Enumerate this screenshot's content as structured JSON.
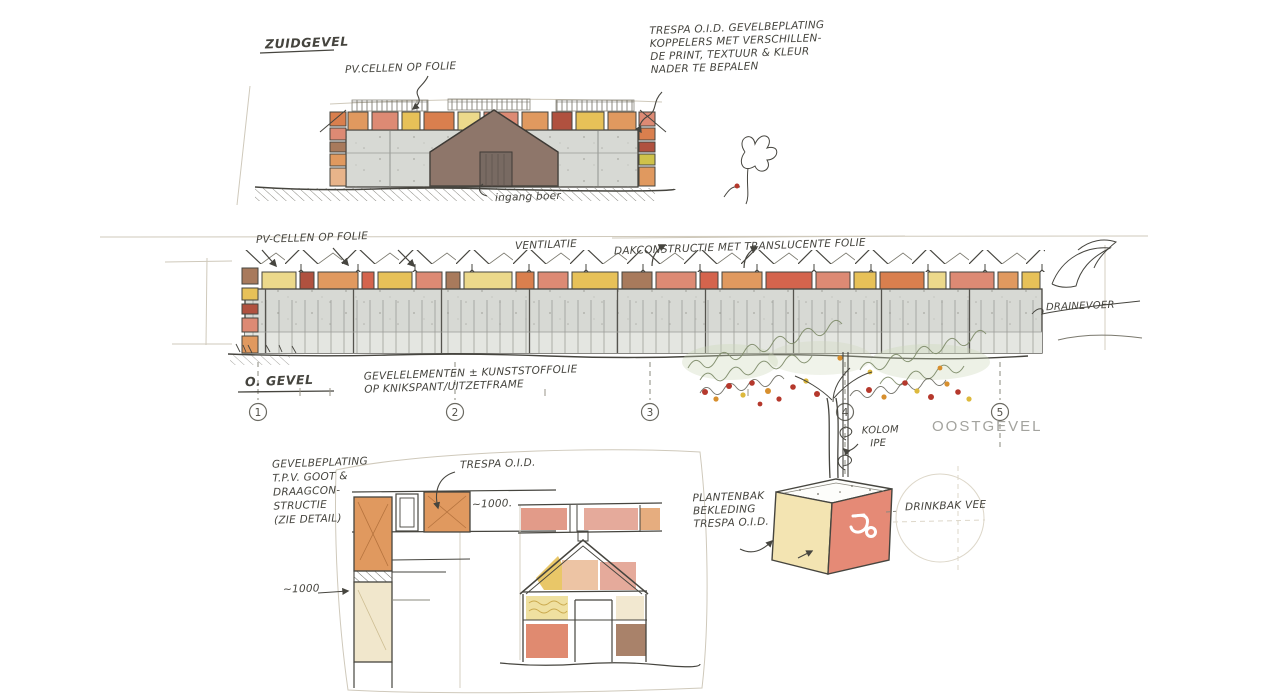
{
  "colors": {
    "ink": "#46453f",
    "paper": "#ffffff",
    "wall_gray": "#d7d9d4",
    "wall_gray_light": "#e4e6e1",
    "accent_orange": "#e0995f",
    "accent_deep_orange": "#d97f4e",
    "accent_yellow_pale": "#ecd98b",
    "accent_yellow_gold": "#e7c158",
    "accent_salmon": "#dd8a74",
    "accent_red": "#d4644d",
    "accent_dark_red": "#b0513f",
    "accent_brown": "#a87a5c",
    "accent_pink": "#e5aa9b",
    "gable_brown": "#8e766a",
    "planter_salmon": "#e58a76",
    "planter_yellow": "#f3e4b2",
    "foliage_green": "#ccd6b8",
    "fruit_red": "#b5382c",
    "fruit_orange": "#d78f2e",
    "fruit_yellow": "#ddb93c",
    "caption_gray": "#a3a39e"
  },
  "south": {
    "title": "ZUIDGEVEL",
    "pv_label": "PV.CELLEN OP FOLIE",
    "entrance_label": "ingang boer",
    "note": [
      "TRESPA O.I.D. GEVELBEPLATING",
      "KOPPELERS MET VERSCHILLEN-",
      "DE PRINT, TEXTUUR & KLEUR",
      "NADER TE BEPALEN"
    ]
  },
  "east": {
    "title": "O. GEVEL",
    "pv_label": "PV-CELLEN OP FOLIE",
    "vent_label": "VENTILATIE",
    "roof_label": "DAKCONSTRUCTIE MET TRANSLUCENTE FOLIE",
    "facade_note": [
      "GEVELELEMENTEN ± KUNSTSTOFFOLIE",
      "OP KNIKSPANT/UITZETFRAME"
    ],
    "drain_label": "DRAINEVOER",
    "caption": "OOSTGEVEL",
    "grid": [
      "1",
      "2",
      "3",
      "4",
      "5"
    ]
  },
  "detail": {
    "note": [
      "GEVELBEPLATING",
      "T.P.V. GOOT &",
      "DRAAGCON-",
      "STRUCTIE",
      "(ZIE DETAIL)"
    ],
    "trespa_label": "TRESPA O.I.D.",
    "dim_top": "~1000.",
    "dim_left": "~1000"
  },
  "planter": {
    "note": [
      "PLANTENBAK",
      "BEKLEDING",
      "TRESPA O.I.D."
    ],
    "column_label": [
      "KOLOM",
      "IPE"
    ],
    "drink_label": "DRINKBAK VEE"
  }
}
